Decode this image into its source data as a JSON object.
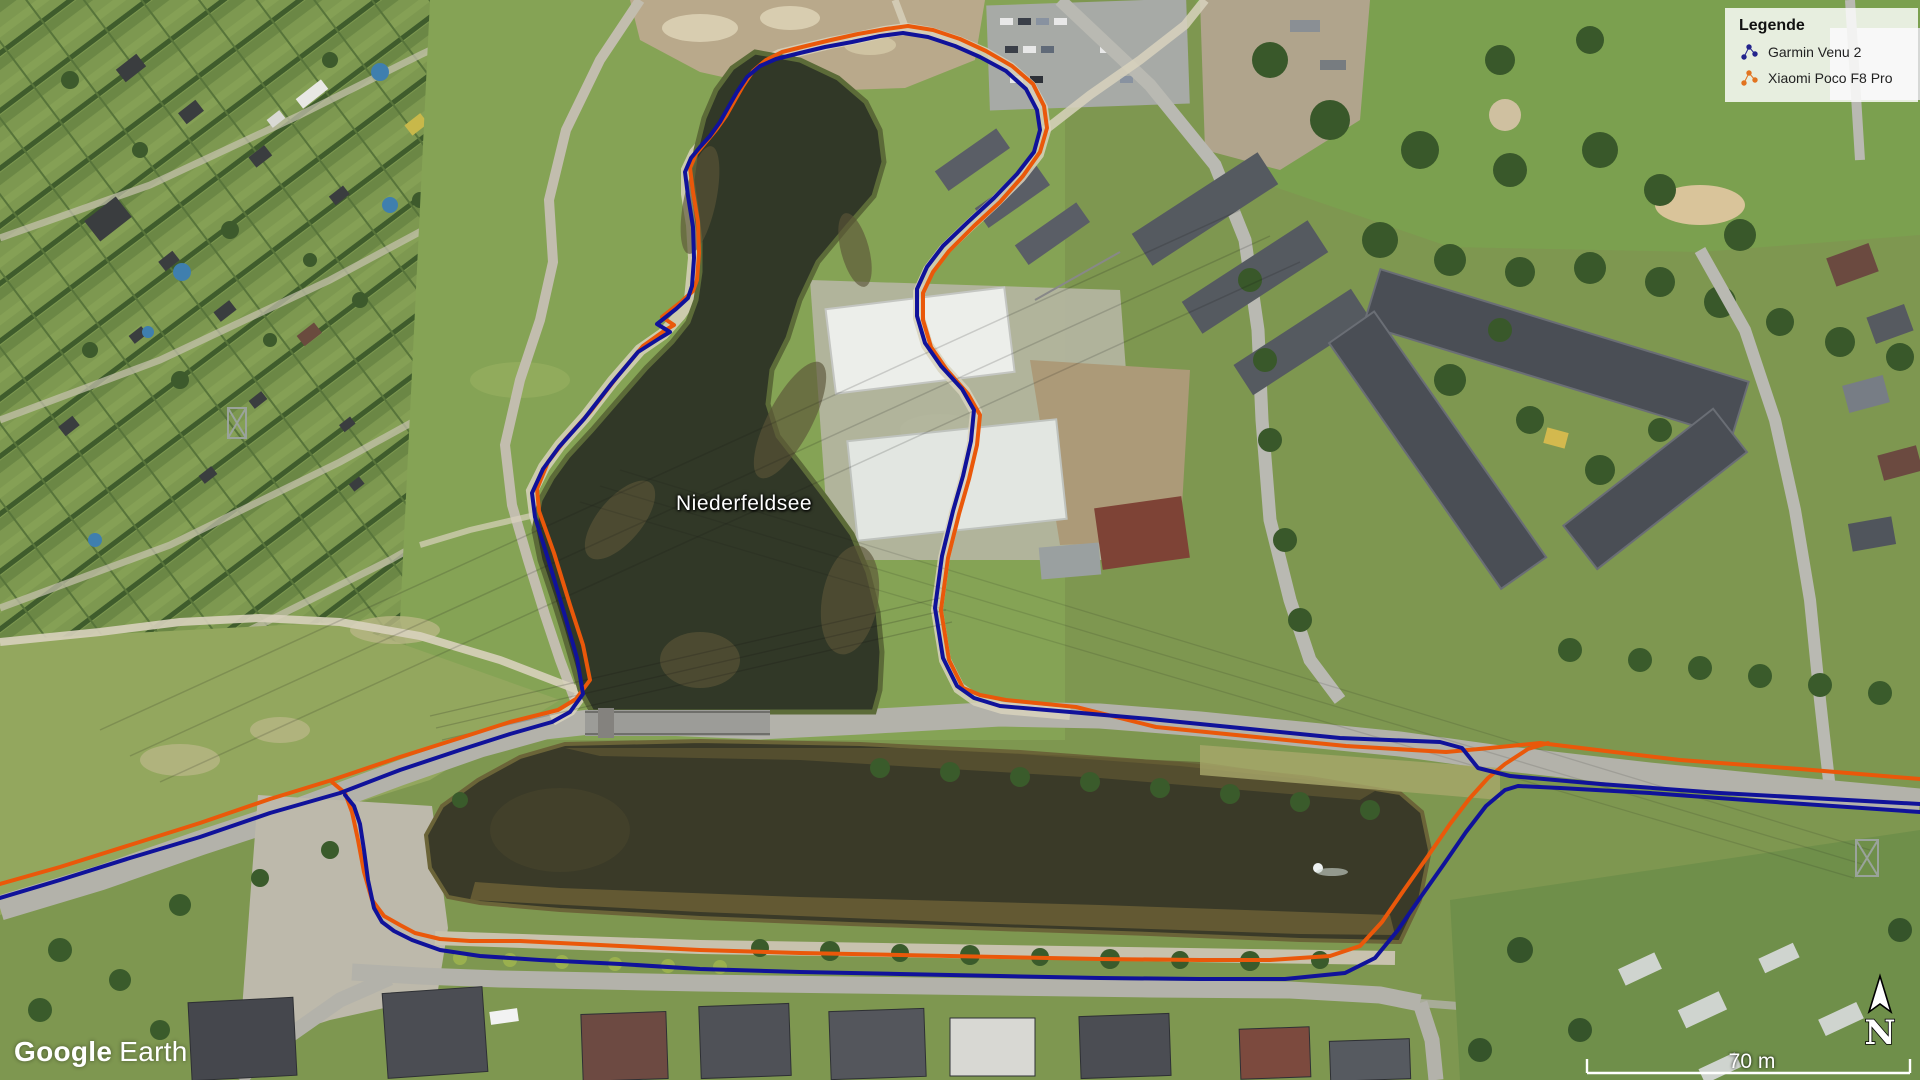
{
  "app": {
    "logo_part1": "Google",
    "logo_part2": "Earth"
  },
  "map": {
    "place_label": "Niederfeldsee"
  },
  "legend": {
    "title": "Legende",
    "items": [
      {
        "label": "Garmin Venu 2",
        "color": "#23238c"
      },
      {
        "label": "Xiaomi Poco F8 Pro",
        "color": "#e2731f"
      }
    ]
  },
  "scale_bar": {
    "label": "70 m"
  },
  "compass": {
    "label": "N"
  },
  "tracks": {
    "garmin": {
      "name": "Garmin Venu 2",
      "color": "#10129a",
      "width": 4,
      "segments": [
        [
          [
            0,
            898
          ],
          [
            60,
            880
          ],
          [
            130,
            858
          ],
          [
            200,
            837
          ],
          [
            270,
            813
          ],
          [
            340,
            793
          ],
          [
            400,
            770
          ],
          [
            460,
            750
          ],
          [
            510,
            734
          ],
          [
            552,
            722
          ],
          [
            570,
            712
          ],
          [
            583,
            694
          ],
          [
            577,
            658
          ],
          [
            565,
            616
          ],
          [
            549,
            562
          ],
          [
            535,
            517
          ],
          [
            532,
            493
          ],
          [
            543,
            469
          ],
          [
            559,
            447
          ],
          [
            584,
            419
          ],
          [
            612,
            383
          ],
          [
            638,
            352
          ],
          [
            660,
            338
          ],
          [
            670,
            332
          ],
          [
            657,
            324
          ],
          [
            676,
            309
          ],
          [
            688,
            298
          ],
          [
            692,
            286
          ],
          [
            694,
            258
          ],
          [
            693,
            227
          ],
          [
            688,
            196
          ],
          [
            685,
            172
          ],
          [
            691,
            158
          ],
          [
            700,
            147
          ],
          [
            710,
            136
          ],
          [
            720,
            122
          ],
          [
            729,
            106
          ],
          [
            737,
            92
          ],
          [
            747,
            77
          ],
          [
            760,
            66
          ],
          [
            776,
            59
          ],
          [
            800,
            53
          ],
          [
            825,
            47
          ],
          [
            852,
            42
          ],
          [
            880,
            36
          ],
          [
            903,
            33
          ],
          [
            928,
            37
          ],
          [
            955,
            46
          ],
          [
            980,
            57
          ],
          [
            1006,
            71
          ],
          [
            1026,
            89
          ],
          [
            1037,
            110
          ],
          [
            1040,
            130
          ],
          [
            1034,
            152
          ],
          [
            1017,
            174
          ],
          [
            994,
            198
          ],
          [
            968,
            222
          ],
          [
            943,
            246
          ],
          [
            927,
            267
          ],
          [
            917,
            289
          ],
          [
            917,
            316
          ],
          [
            925,
            343
          ],
          [
            941,
            366
          ],
          [
            962,
            389
          ],
          [
            974,
            410
          ],
          [
            971,
            441
          ],
          [
            963,
            476
          ],
          [
            953,
            511
          ],
          [
            942,
            556
          ],
          [
            935,
            608
          ],
          [
            943,
            658
          ],
          [
            957,
            686
          ],
          [
            974,
            698
          ],
          [
            1000,
            706
          ],
          [
            1070,
            712
          ],
          [
            1150,
            719
          ],
          [
            1250,
            729
          ],
          [
            1340,
            738
          ],
          [
            1440,
            742
          ],
          [
            1462,
            748
          ],
          [
            1478,
            768
          ],
          [
            1510,
            776
          ],
          [
            1600,
            784
          ],
          [
            1720,
            793
          ],
          [
            1920,
            804
          ]
        ],
        [
          [
            345,
            795
          ],
          [
            354,
            806
          ],
          [
            360,
            824
          ],
          [
            364,
            850
          ],
          [
            368,
            880
          ],
          [
            374,
            908
          ],
          [
            382,
            922
          ],
          [
            394,
            931
          ],
          [
            412,
            940
          ],
          [
            440,
            950
          ],
          [
            480,
            956
          ],
          [
            540,
            960
          ],
          [
            620,
            964
          ],
          [
            700,
            969
          ],
          [
            800,
            972
          ],
          [
            900,
            974
          ],
          [
            1000,
            976
          ],
          [
            1100,
            978
          ],
          [
            1200,
            979
          ],
          [
            1285,
            979
          ],
          [
            1345,
            973
          ],
          [
            1375,
            958
          ],
          [
            1398,
            930
          ],
          [
            1420,
            898
          ],
          [
            1444,
            864
          ],
          [
            1466,
            832
          ],
          [
            1486,
            806
          ],
          [
            1505,
            790
          ],
          [
            1518,
            786
          ],
          [
            1560,
            788
          ],
          [
            1650,
            793
          ],
          [
            1760,
            801
          ],
          [
            1920,
            812
          ]
        ]
      ]
    },
    "xiaomi": {
      "name": "Xiaomi Poco F8 Pro",
      "color": "#ea580a",
      "width": 4,
      "segments": [
        [
          [
            0,
            884
          ],
          [
            60,
            867
          ],
          [
            130,
            845
          ],
          [
            200,
            823
          ],
          [
            270,
            799
          ],
          [
            332,
            780
          ],
          [
            400,
            757
          ],
          [
            460,
            738
          ],
          [
            510,
            722
          ],
          [
            558,
            710
          ],
          [
            576,
            699
          ],
          [
            590,
            680
          ],
          [
            583,
            645
          ],
          [
            570,
            605
          ],
          [
            554,
            553
          ],
          [
            539,
            511
          ],
          [
            537,
            489
          ],
          [
            548,
            462
          ],
          [
            565,
            440
          ],
          [
            590,
            412
          ],
          [
            617,
            377
          ],
          [
            643,
            346
          ],
          [
            664,
            331
          ],
          [
            674,
            325
          ],
          [
            662,
            317
          ],
          [
            681,
            302
          ],
          [
            693,
            291
          ],
          [
            697,
            280
          ],
          [
            699,
            253
          ],
          [
            698,
            222
          ],
          [
            693,
            192
          ],
          [
            690,
            168
          ],
          [
            696,
            154
          ],
          [
            706,
            142
          ],
          [
            716,
            130
          ],
          [
            726,
            116
          ],
          [
            735,
            100
          ],
          [
            743,
            86
          ],
          [
            753,
            71
          ],
          [
            766,
            60
          ],
          [
            782,
            52
          ],
          [
            806,
            46
          ],
          [
            831,
            40
          ],
          [
            858,
            34
          ],
          [
            886,
            29
          ],
          [
            908,
            26
          ],
          [
            933,
            30
          ],
          [
            960,
            39
          ],
          [
            986,
            51
          ],
          [
            1012,
            66
          ],
          [
            1033,
            84
          ],
          [
            1044,
            106
          ],
          [
            1047,
            128
          ],
          [
            1040,
            152
          ],
          [
            1023,
            176
          ],
          [
            1000,
            202
          ],
          [
            974,
            226
          ],
          [
            949,
            251
          ],
          [
            933,
            272
          ],
          [
            923,
            293
          ],
          [
            923,
            320
          ],
          [
            931,
            347
          ],
          [
            947,
            370
          ],
          [
            968,
            394
          ],
          [
            980,
            415
          ],
          [
            977,
            445
          ],
          [
            969,
            479
          ],
          [
            959,
            514
          ],
          [
            948,
            558
          ],
          [
            941,
            610
          ],
          [
            949,
            660
          ],
          [
            963,
            688
          ],
          [
            980,
            695
          ],
          [
            1006,
            700
          ],
          [
            1076,
            707
          ],
          [
            1156,
            727
          ],
          [
            1256,
            737
          ],
          [
            1346,
            746
          ],
          [
            1446,
            752
          ],
          [
            1490,
            748
          ],
          [
            1540,
            743
          ],
          [
            1680,
            760
          ],
          [
            1800,
            769
          ],
          [
            1920,
            779
          ]
        ],
        [
          [
            332,
            782
          ],
          [
            345,
            793
          ],
          [
            352,
            812
          ],
          [
            358,
            840
          ],
          [
            364,
            872
          ],
          [
            372,
            900
          ],
          [
            384,
            916
          ],
          [
            400,
            925
          ],
          [
            415,
            933
          ],
          [
            440,
            939
          ],
          [
            470,
            941
          ],
          [
            520,
            941
          ],
          [
            560,
            943
          ],
          [
            620,
            946
          ],
          [
            700,
            950
          ],
          [
            800,
            953
          ],
          [
            900,
            955
          ],
          [
            1000,
            957
          ],
          [
            1100,
            959
          ],
          [
            1200,
            960
          ],
          [
            1270,
            960
          ],
          [
            1330,
            956
          ],
          [
            1360,
            946
          ],
          [
            1382,
            922
          ],
          [
            1404,
            890
          ],
          [
            1428,
            856
          ],
          [
            1450,
            824
          ],
          [
            1470,
            798
          ],
          [
            1488,
            778
          ],
          [
            1505,
            764
          ],
          [
            1528,
            749
          ],
          [
            1548,
            743
          ]
        ]
      ]
    }
  }
}
